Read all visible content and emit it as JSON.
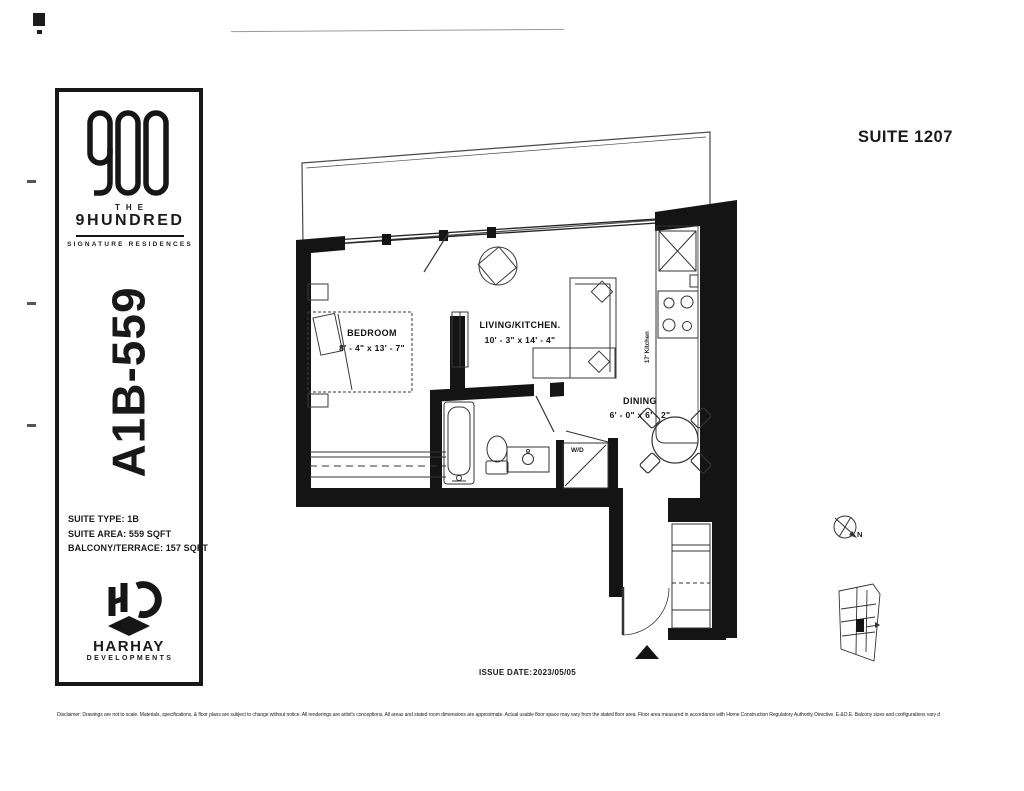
{
  "page": {
    "suite_title": "SUITE 1207",
    "issue_date_label": "ISSUE DATE:",
    "issue_date_value": "2023/05/05",
    "disclaimer": "Disclaimer: Drawings are not to scale. Materials, specifications, & floor plans are subject to change without notice. All renderings are artist's conceptions. All areas and stated room dimensions are approximate. Actual usable floor space may vary from the stated floor area. Floor area measured in accordance with Home Construction Regulatory Authority Directive. E.&O.E. Balcony sizes and configurations vary depending on floor level/locations."
  },
  "sidebar": {
    "brand": {
      "the": "THE",
      "name": "9HUNDRED",
      "tagline": "SIGNATURE RESIDENCES"
    },
    "model": "A1B-559",
    "specs": {
      "type": "SUITE TYPE: 1B",
      "area": "SUITE AREA: 559 SQFT",
      "balcony": "BALCONY/TERRACE: 157 SQFT"
    },
    "developer": {
      "name": "HARHAY",
      "sub": "DEVELOPMENTS"
    }
  },
  "plan": {
    "rooms": {
      "bedroom": {
        "label": "BEDROOM",
        "dims": "8' - 4\" x 13' - 7\""
      },
      "living": {
        "label": "LIVING/KITCHEN.",
        "dims": "10' - 3\" x 14' - 4\""
      },
      "dining": {
        "label": "DINING",
        "dims": "6' - 0\" x 6' - 2\""
      },
      "laundry": {
        "label": "W/D"
      },
      "kitchen": {
        "label": "17' Kitchen"
      }
    },
    "compass_label": "N"
  }
}
